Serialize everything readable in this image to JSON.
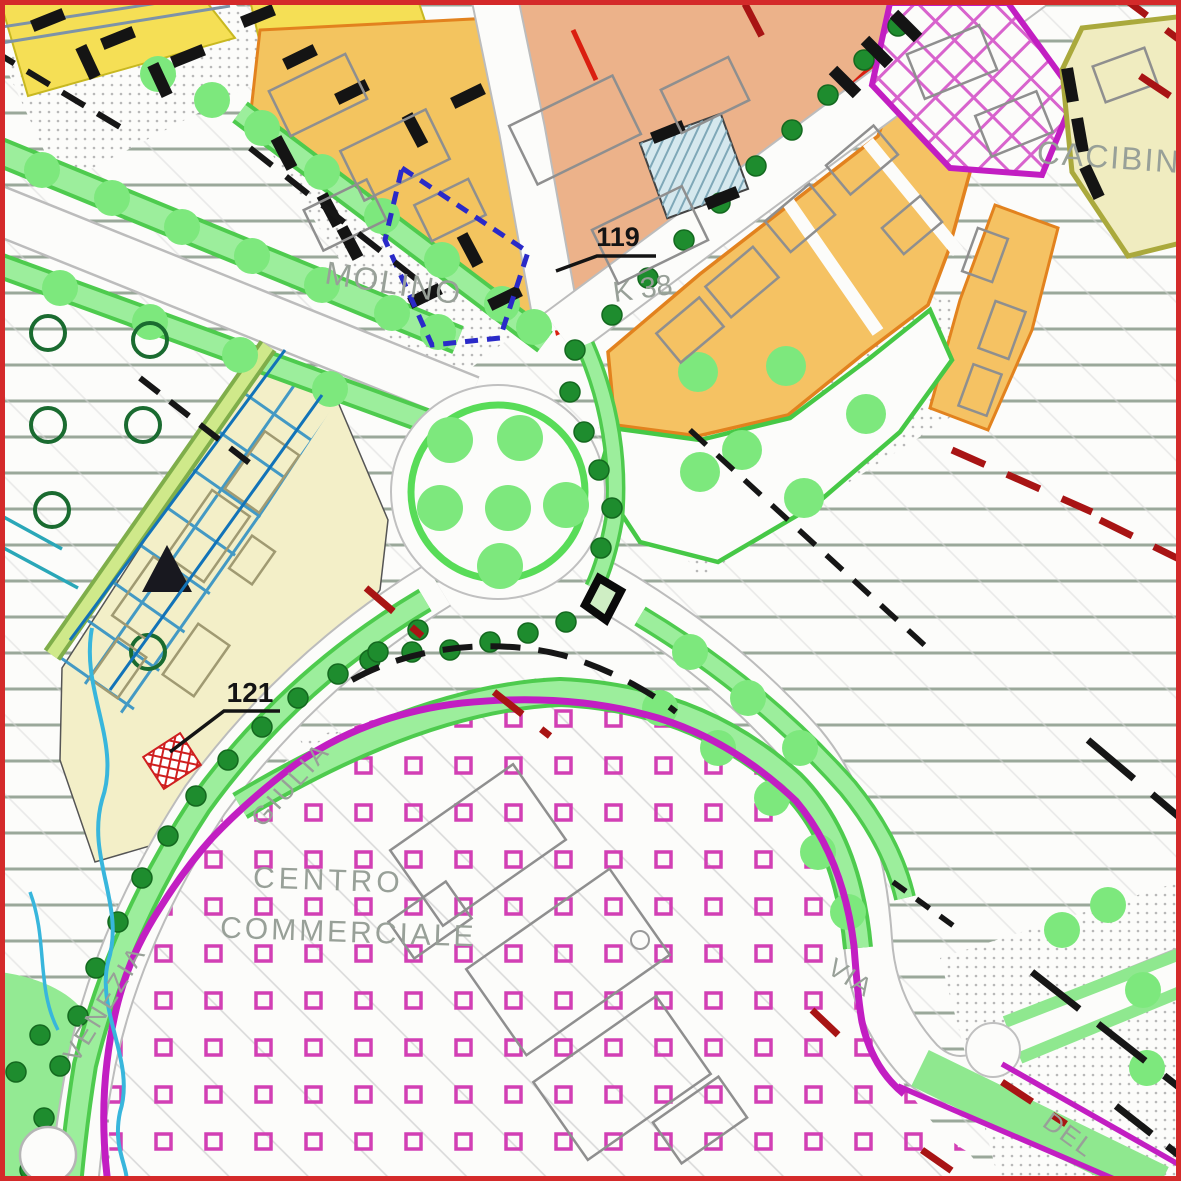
{
  "map": {
    "type": "zoning-plan",
    "labels": {
      "parcel_119": "119",
      "parcel_121": "121",
      "k38": "K 38",
      "molino": "MOLINO",
      "cacibin": "CACIBIN",
      "centro": "CENTRO",
      "commerciale": "COMMERCIALE",
      "via_venezia": "VENEZIA",
      "via_giulia": "GIULIA",
      "via": "VIA",
      "del": "DEL"
    },
    "colors": {
      "frame_red": "#d42a2a",
      "hatch_sage": "#9aa89a",
      "zone_gold": "#f3c45f",
      "zone_salmon": "#ecb28a",
      "zone_orange": "#f5c263",
      "zone_pale_yellow": "#f3efc8",
      "zone_cream": "#f0ecc0",
      "commercial_boundary_magenta": "#c21ec2",
      "pink_square": "#d23fb4",
      "green_strip": "#8fe88f",
      "green_ring": "#58dc58",
      "tree_dark_green": "#1e8c2e",
      "red_border": "#da1f10",
      "red_dash": "#a81414",
      "blue_dash": "#2a2ac8",
      "canal_blue": "#2f8fc4",
      "stream_cyan": "#38b6dc",
      "building_gray": "#8f8f8f",
      "label_gray": "#98a098"
    },
    "features": {
      "trees_dark": [
        [
          575,
          350
        ],
        [
          612,
          315
        ],
        [
          648,
          278
        ],
        [
          684,
          240
        ],
        [
          720,
          203
        ],
        [
          756,
          166
        ],
        [
          792,
          130
        ],
        [
          828,
          95
        ],
        [
          864,
          60
        ],
        [
          898,
          26
        ],
        [
          570,
          392
        ],
        [
          584,
          432
        ],
        [
          599,
          470
        ],
        [
          612,
          508
        ],
        [
          601,
          548
        ],
        [
          370,
          660
        ],
        [
          412,
          652
        ],
        [
          450,
          650
        ],
        [
          490,
          642
        ],
        [
          528,
          633
        ],
        [
          566,
          622
        ],
        [
          418,
          630
        ],
        [
          378,
          652
        ],
        [
          338,
          674
        ],
        [
          298,
          698
        ],
        [
          262,
          727
        ],
        [
          228,
          760
        ],
        [
          196,
          796
        ],
        [
          168,
          836
        ],
        [
          142,
          878
        ],
        [
          118,
          922
        ],
        [
          96,
          968
        ],
        [
          78,
          1016
        ],
        [
          60,
          1066
        ],
        [
          44,
          1118
        ],
        [
          30,
          1170
        ],
        [
          40,
          1035
        ],
        [
          16,
          1072
        ]
      ],
      "trees_light": [
        [
          42,
          170
        ],
        [
          112,
          198
        ],
        [
          182,
          227
        ],
        [
          252,
          256
        ],
        [
          322,
          285
        ],
        [
          392,
          313
        ],
        [
          438,
          332
        ],
        [
          60,
          288
        ],
        [
          150,
          322
        ],
        [
          240,
          355
        ],
        [
          330,
          389
        ],
        [
          262,
          128
        ],
        [
          322,
          172
        ],
        [
          382,
          216
        ],
        [
          442,
          260
        ],
        [
          502,
          304
        ],
        [
          534,
          327
        ],
        [
          660,
          708
        ],
        [
          718,
          748
        ],
        [
          772,
          798
        ],
        [
          818,
          852
        ],
        [
          848,
          912
        ],
        [
          690,
          652
        ],
        [
          748,
          698
        ],
        [
          800,
          748
        ],
        [
          1143,
          990
        ],
        [
          1147,
          1068
        ],
        [
          1062,
          930
        ],
        [
          1108,
          905
        ],
        [
          158,
          74
        ],
        [
          212,
          100
        ]
      ],
      "roundabout_dots": [
        [
          450,
          440
        ],
        [
          520,
          438
        ],
        [
          440,
          508
        ],
        [
          508,
          508
        ],
        [
          566,
          505
        ],
        [
          500,
          566
        ]
      ],
      "zone_dots": [
        [
          698,
          372
        ],
        [
          786,
          366
        ],
        [
          742,
          450
        ],
        [
          804,
          498
        ],
        [
          700,
          472
        ],
        [
          866,
          414
        ]
      ],
      "open_circles": [
        [
          48,
          333
        ],
        [
          150,
          340
        ],
        [
          48,
          425
        ],
        [
          143,
          425
        ],
        [
          52,
          510
        ],
        [
          148,
          652
        ]
      ],
      "wall_bars": [
        [
          300,
          57,
          -26
        ],
        [
          352,
          92,
          -26
        ],
        [
          468,
          96,
          -26
        ],
        [
          350,
          243,
          62
        ],
        [
          425,
          296,
          -26
        ],
        [
          470,
          250,
          62
        ],
        [
          284,
          153,
          62
        ],
        [
          415,
          130,
          62
        ],
        [
          505,
          298,
          -26
        ],
        [
          330,
          210,
          62
        ],
        [
          48,
          20,
          -22
        ],
        [
          118,
          38,
          -22
        ],
        [
          188,
          56,
          -22
        ],
        [
          258,
          16,
          -22
        ],
        [
          88,
          62,
          65
        ],
        [
          160,
          80,
          65
        ],
        [
          845,
          82,
          45
        ],
        [
          877,
          52,
          45
        ],
        [
          906,
          26,
          45
        ],
        [
          1070,
          85,
          80
        ],
        [
          1080,
          135,
          80
        ],
        [
          1092,
          182,
          65
        ],
        [
          668,
          132,
          -22
        ],
        [
          722,
          198,
          -22
        ]
      ],
      "buildings_gray": [
        [
          318,
          95,
          85,
          50,
          -26
        ],
        [
          395,
          155,
          95,
          55,
          -26
        ],
        [
          345,
          215,
          70,
          45,
          -26
        ],
        [
          450,
          210,
          60,
          40,
          -26
        ],
        [
          575,
          130,
          115,
          65,
          -26
        ],
        [
          650,
          235,
          100,
          60,
          -26
        ],
        [
          705,
          95,
          75,
          48,
          -26
        ],
        [
          690,
          330,
          56,
          38,
          -40
        ],
        [
          742,
          282,
          62,
          40,
          -40
        ],
        [
          800,
          218,
          58,
          40,
          -40
        ],
        [
          862,
          160,
          62,
          38,
          -40
        ],
        [
          912,
          225,
          50,
          34,
          -40
        ],
        [
          985,
          255,
          46,
          32,
          -70
        ],
        [
          1002,
          330,
          50,
          32,
          -70
        ],
        [
          980,
          390,
          44,
          30,
          -70
        ],
        [
          952,
          62,
          78,
          48,
          -22
        ],
        [
          1014,
          124,
          66,
          44,
          -22
        ],
        [
          478,
          845,
          150,
          92,
          -35
        ],
        [
          568,
          962,
          175,
          105,
          -35
        ],
        [
          622,
          1078,
          150,
          95,
          -35
        ],
        [
          430,
          920,
          70,
          45,
          -35
        ],
        [
          700,
          1120,
          80,
          50,
          -35
        ],
        [
          1125,
          75,
          55,
          38,
          -20
        ]
      ],
      "buildings_tan": [
        [
          150,
          598,
          72,
          42,
          -55
        ],
        [
          208,
          536,
          80,
          46,
          -55
        ],
        [
          262,
          472,
          70,
          42,
          -55
        ],
        [
          196,
          660,
          62,
          38,
          -55
        ],
        [
          118,
          668,
          50,
          34,
          -55
        ],
        [
          252,
          560,
          40,
          28,
          -55
        ]
      ]
    }
  }
}
